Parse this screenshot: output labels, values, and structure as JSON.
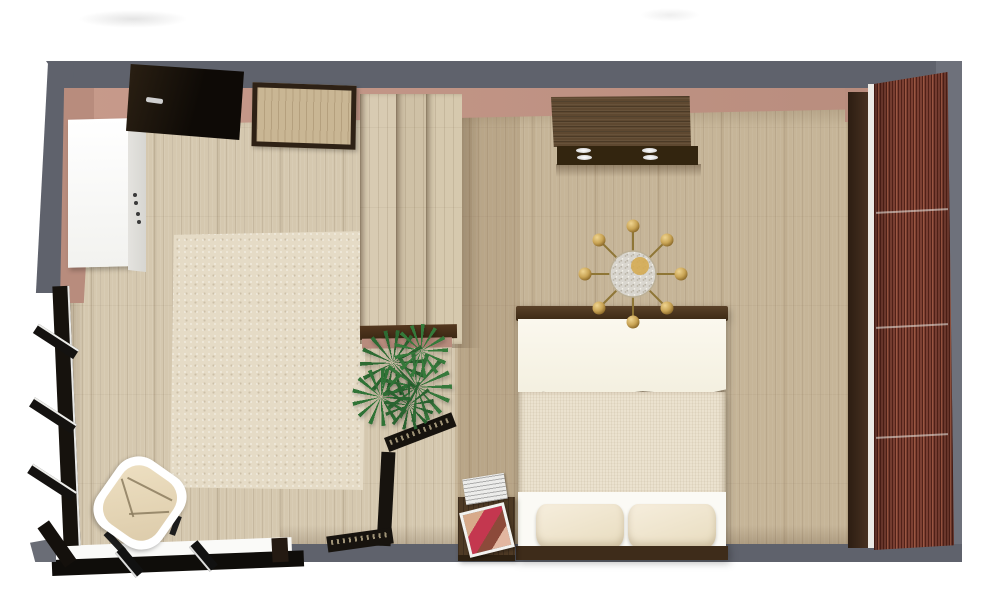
{
  "scene": {
    "type": "3d-floorplan-top-view",
    "objects": {
      "door": "entry-door",
      "mirror": "wall-mirror",
      "cabinet": "white-cabinet",
      "rug": "area-rug",
      "chair": "armchair",
      "windows": "window-wall",
      "divider": "room-divider",
      "plant": "potted-palm",
      "screen": "folding-screen",
      "dresser": "dresser",
      "chandelier": "ceiling-chandelier",
      "bed": "double-bed",
      "nightstand": "nightstand",
      "magazines": "magazines",
      "wardrobe": "mahogany-wardrobe"
    }
  },
  "palette": {
    "wall_gray": "#5f626c",
    "wall_gray_light": "#6e717b",
    "wall_pink": "#c79a8b",
    "wall_pink_deep": "#b88c7d",
    "floor_light": "#d5c8af",
    "rug": "#e5dbc6",
    "cabinet_side": "#d7d6d1",
    "dark_wood": "#5e4830",
    "dark_wood_face": "#33250f",
    "walnut": "#4e3a25",
    "mahogany": "#7c4033",
    "wardrobe_side": "#4a3322",
    "linen": "#f3efdf",
    "duvet": "#ebe2cf",
    "pillow": "#e8dcbf",
    "headboard": "#3e2c1a",
    "gold": "#c9a455",
    "crystal": "#d9d6cf",
    "plant_green": "#37793c",
    "screen_black": "#17130e",
    "magazine_red": "#c4374f"
  }
}
